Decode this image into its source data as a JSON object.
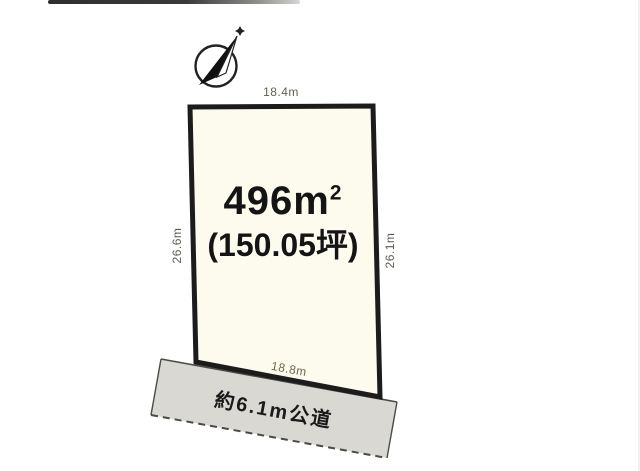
{
  "meta": {
    "description": "Japanese real-estate land plot diagram",
    "colors": {
      "background": "#ffffff",
      "plot_fill": "#fdfbee",
      "plot_border": "#1c1c1c",
      "road_fill": "#d9d8d3",
      "road_border": "#4a4a46",
      "dimension_text": "#615f50",
      "area_text": "#141414",
      "scan_streak": "#3a3a3a"
    }
  },
  "compass": {
    "icon": "compass-north-needle-icon"
  },
  "plot": {
    "area_value": "496",
    "area_unit": "m",
    "area_exponent": "2",
    "area_tsubo": "(150.05坪)",
    "dimensions": {
      "top": "18.4m",
      "bottom": "18.8m",
      "left": "26.6m",
      "right": "26.1m"
    }
  },
  "road": {
    "label": "約6.1m公道"
  }
}
